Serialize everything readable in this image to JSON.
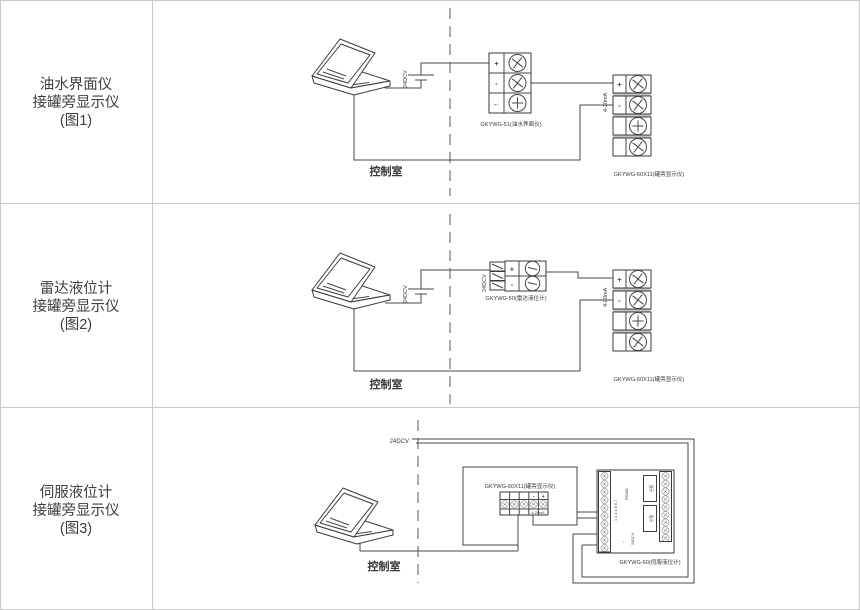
{
  "figure": {
    "colors": {
      "line": "#474747",
      "divider": "#c9c9c9",
      "text": "#3a3a3a"
    },
    "rows": [
      {
        "id": "fig1",
        "title_lines": [
          "油水界面仪",
          "接罐旁显示仪",
          "(图1)"
        ],
        "control_room": "控制室",
        "power_label": "24DCV",
        "signal_label": "4-20mA",
        "transmitter": {
          "label": "GKYWG-51(油水界面仪)",
          "terminals": [
            "+",
            "-",
            "←"
          ]
        },
        "display": {
          "label": "GKYWG-60X11(罐旁显示仪)",
          "terminals": [
            "+",
            "-"
          ]
        }
      },
      {
        "id": "fig2",
        "title_lines": [
          "雷达液位计",
          "接罐旁显示仪",
          "(图2)"
        ],
        "control_room": "控制室",
        "power_label": "24DCV",
        "block_power_label": "24DCV",
        "signal_label": "4-20mA",
        "transmitter": {
          "label": "GKYWG-50(雷达液位计)",
          "terminals": [
            "+",
            "-"
          ]
        },
        "display": {
          "label": "GKYWG-60X11(罐旁显示仪)",
          "terminals": [
            "+",
            "-"
          ]
        }
      },
      {
        "id": "fig3",
        "title_lines": [
          "伺服液位计",
          "接罐旁显示仪",
          "(图3)"
        ],
        "control_room": "控制室",
        "power_label": "24DCV",
        "display": {
          "label": "GKYWG-60X11(罐旁显示仪)",
          "terminals": [
            "-",
            "+"
          ],
          "signal_label": "4-20mA"
        },
        "servo": {
          "label": "GKYWG-60(伺服液位计)",
          "rs485_label": "RS485",
          "power_label": "24DCV",
          "module_label": "显示",
          "terminal_numbers": "1 2 3 4 5 6 7",
          "arrow": "↑"
        }
      }
    ]
  }
}
